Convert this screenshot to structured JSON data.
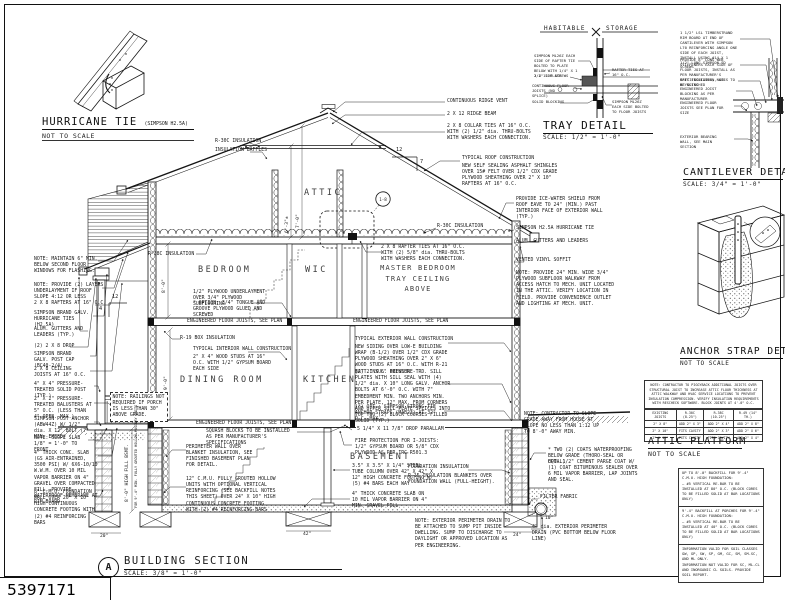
{
  "sheet": {
    "number": "5397171",
    "ink": "#1a1a1a",
    "paper": "#ffffff"
  },
  "hurricane_tie_detail": {
    "title": "HURRICANE TIE",
    "subtitle": "(SIMPSON H2.5A)",
    "scale": "NOT TO SCALE"
  },
  "tray_detail": {
    "title": "TRAY DETAIL",
    "scale": "SCALE: 1/2\" = 1'-0\"",
    "zone_left": "HABITABLE",
    "zone_right": "STORAGE",
    "labels": {
      "simpson_top": "SIMPSON ML26Z EACH SIDE OF RAFTER TIE BOLTED TO PLATE BELOW WITH 1/4\" X 1 1/2\" SDS SCREWS",
      "plate": "2 X 12 PLATE",
      "rafter_ties": "RAFTER TIES AT 16\" O.C.",
      "floor_joists": "CONTINUOUS FLOOR JOISTS (NO SPLICE)",
      "blocking": "SOLID BLOCKING",
      "simpson_bottom": "SIMPSON ML26Z EACH SIDE BOLTED TO FLOOR JOISTS"
    }
  },
  "cantilever_detail": {
    "title": "CANTILEVER DETAIL",
    "scale": "SCALE: 3/4\" = 1'-0\"",
    "labels": {
      "rim_board": "1 1/2\" LSL TIMBERSTRAND RIM BOARD AT END OF CANTILEVER WITH SIMPSON L70 REINFORCING ANGLE ONE SIDE OF EACH JOIST, INSTALL USING #14 X 1 1/2\" LONG SIMPSON SD SCREWS",
      "web_stiffeners": "PROVIDE 8\" LONG WEB STIFFENERS EACH SIDE OF FLOOR JOISTS, INSTALL AS PER MANUFACTURER'S SPECIFICATIONS, NAILS TO BE CLINCHED",
      "batt_insulation": "BATT INSULATION, SEE KEYNOTES",
      "joist_blocking": "ENGINEERED JOIST BLOCKING AS PER MANUFACTURER",
      "floor_joists": "ENGINEERED FLOOR JOISTS SEE PLAN FOR SIZE",
      "bearing_wall": "EXTERIOR BEARING WALL, SEE MAIN SECTION"
    }
  },
  "anchor_strap_detail": {
    "title": "ANCHOR STRAP DETAIL",
    "scale": "NOT TO SCALE"
  },
  "attic_platform": {
    "title": "ATTIC PLATFORM",
    "scale": "NOT TO SCALE",
    "note": "NOTE: CONTRACTOR TO PIGGYBACK ADDITIONAL JOISTS OVER STRUCTURAL JOIST TO INCREASE ATTIC FLOOR THICKNESS AT ATTIC WALKWAY AND HVAC SERVICE LOCATIONS TO PREVENT INSULATION COMPRESSION. VERIFY INSULATION REQUIREMENTS WITH RESCHECK SOFTWARE. BLOCK JOINTS AT 4'-0\" O.C.",
    "table": {
      "headers": [
        "EXISTING JOISTS",
        "R-30C (8.25\")",
        "R-38C (10.25\")",
        "R-49 (14\" TH.)"
      ],
      "rows": [
        [
          "2\" X 8\"",
          "ADD 2\" X 3\"",
          "ADD 2\" X 4\"",
          "ADD 2\" X 8\""
        ],
        [
          "2\" X 10\"",
          "FITS CAVITY",
          "ADD 2\" X 3\"",
          "ADD 2\" X 6\""
        ],
        [
          "2\" X 12\"",
          "FITS CAVITY",
          "FITS CAVITY",
          "ADD 2\" X 4\""
        ]
      ]
    }
  },
  "backfill_notes": {
    "s1_title": "UP TO 8'-0\" BACKFILL FOR 9'-4\" C.M.U. HIGH FOUNDATION:",
    "s1_body": "— #5 VERTICAL RE-BAR TO BE INSTALLED AT 80\" O.C. (BLOCK CORES TO BE FILLED SOLID AT BAR LOCATIONS ONLY)",
    "s2_title": "9'-4\" BACKFILL AT PORCHES FOR 9'-4\" C.M.U. HIGH FOUNDATION:",
    "s2_body": "— #5 VERTICAL RE-BAR TO BE INSTALLED AT 40\" O.C. (BLOCK CORES TO BE FILLED SOLID AT BAR LOCATIONS ONLY)",
    "s3_a": "INFORMATION VALID FOR SOIL CLASSES GW, GP, SW, SP, GM, GC, SM, SM-SC, AND ML ONLY.",
    "s3_b": "INFORMATION NOT VALID FOR SC, ML-CL AND INORGANIC CL SOILS. PROVIDE SOIL REPORT."
  },
  "section": {
    "marker": "A",
    "title": "BUILDING SECTION",
    "scale": "SCALE: 3/8\" = 1'-0\"",
    "rooms": {
      "attic": "ATTIC",
      "bedroom": "BEDROOM",
      "wic": "WIC",
      "master_line1": "MASTER BEDROOM",
      "master_line2": "TRAY CEILING ABOVE",
      "dining": "DINING ROOM",
      "kitchen": "KITCHEN",
      "basement": "BASEMENT"
    },
    "dims": {
      "attic_collar": "6'-3\"±",
      "attic_ridge": "7'-0\"",
      "second_floor": "8'-0\"",
      "first_floor": "9'-0\"",
      "bsmt1": "8'-0\" HIGH FULL BSMT.",
      "bsmt2": "FOR 9'-4\" MIN. FULLY GROUTED HOLLOW MASONRY UNITS",
      "d20": "20\"",
      "d42": "42\"",
      "d24": "24\"",
      "d10": "10\"",
      "pitch_run_main": "12",
      "pitch_rise_main": "7",
      "pitch_run_porch": "12",
      "pitch_rise_porch": "4",
      "bubble_ref": "1-8"
    },
    "labels": {
      "flashing_note": "NOTE: MAINTAIN 6\" MIN. BELOW SECOND FLOOR WINDOWS FOR FLASHING.",
      "underlayment_note": "NOTE: PROVIDE (2) LAYERS UNDERLAYMENT IF ROOF SLOPE 4:12 OR LESS",
      "porch_rafters": "2 X 8 RAFTERS AT 16\" O.C.",
      "porch_hurricane_ties": "SIMPSON BRAND GALV. HURRICANE TIES (H2.5A)",
      "porch_gutters": "ALUM. GUTTERS AND LEADERS (TYP.)",
      "porch_drop": "(2) 2 X 8 DROP",
      "post_cap": "SIMPSON BRAND GALV. POST CAP (BC40-2/4)",
      "porch_ceiling_joists": "2 X 8 CEILING JOISTS AT 16\" O.C.",
      "solid_post": "4\" X 4\" PRESSURE-TREATED SOLID POST (TYP.)",
      "balusters": "2\" X 2\" PRESSURE-TREATED BALUSTERS AT 5\" O.C. (LESS THAN 4\" OPEN. MAX.)",
      "post_anchor": "SIMPSON POST ANCHOR (ABW44Z) W/ 1/2\" dia. X 12\" BOLT (7\" MIN. EMBED)",
      "slope_slab_note": "NOTE: SLOPE SLAB 1/8\" = 1'-0\" TO FRONT",
      "porch_slab": "4\" THICK CONC. SLAB (GS AIR-ENTRAINED, 3500 PSI) W/ 6X6-10/10 W.W.M. OVER 10 MIL VAPOR BARRIER ON 4\" GRAVEL OVER COMPACTED FILL, PROVIDE WATERPROOF MEMBRANE AT RIM BOARD",
      "cmu8_foundation": "8\" C.M.U. FOUNDATION WALL OVER 20\" X 10\" HIGH CONTINUOUS CONCRETE FOOTING WITH (2) #4 REINFORCING BARS",
      "railing_note": "NOTE: RAILINGS NOT REQUIRED IF PORCH IS LESS THAN 30\" ABOVE GRADE.",
      "ridge_vent": "CONTINUOUS RIDGE VENT",
      "ridge_beam": "2 X 12 RIDGE BEAM",
      "collar_ties": "2 X 8 COLLAR TIES AT 16\" O.C. WITH (2) 1/2\" dia. THRU-BOLTS WITH WASHERS EACH CONNECTION.",
      "roof_construction_title": "TYPICAL ROOF CONSTRUCTION",
      "roof_construction_spec": "NEW SELF SEALING ASPHALT SHINGLES OVER 15# FELT OVER 1/2\" CDX GRADE PLYWOOD SHEATHING OVER 2\" X 10\" RAFTERS AT 16\" O.C.",
      "ice_water_shield": "PROVIDE ICE-WATER SHIELD FROM ROOF EAVE TO 24\" (MIN.) PAST INTERIOR FACE OF EXTERIOR WALL (TYP.)",
      "hurricane_tie": "SIMPSON H2.5A HURRICANE TIE",
      "gutters_leaders": "ALUM. GUTTERS AND LEADERS",
      "vinyl_soffit": "VENTED VINYL SOFFIT",
      "attic_walkway_note": "NOTE: PROVIDE 24\" MIN. WIDE 3/4\" PLYWOOD SUBFLOOR WALKWAY FROM ACCESS HATCH TO MECH. UNIT LOCATED IN THE ATTIC. VERIFY LOCATION IN FIELD. PROVIDE CONVENIENCE OUTLET AND LIGHTING AT MECH. UNIT.",
      "rafter_ties": "2 X 8 RAFTER TIES AT 16\" O.C. WITH (2) 5/8\" dia. THRU-BOLTS WITH WASHERS EACH CONNECTION.",
      "r30c_left": "R-30C INSULATION",
      "insulation_baffles": "INSULATION BAFFLES",
      "r30c_right": "R-30C INSULATION",
      "r38c": "R-38C INSULATION",
      "subfloor": "1/2\" PLYWOOD UNDERLAYMENT OVER 3/4\" PLYWOOD SUBFLOORING",
      "subfloor_option": "* OPTION: 3/4\" TONGUE AND GROOVE PLYWOOD GLUED AND SCREWED",
      "efj": "ENGINEERED FLOOR JOISTS, SEE PLAN",
      "r19_box": "R-19 BOX INSULATION",
      "interior_wall_title": "TYPICAL INTERIOR WALL CONSTRUCTION",
      "interior_wall_spec": "2\" X 4\" WOOD STUDS AT 16\" O.C. WITH 1/2\" GYPSUM BOARD EACH SIDE",
      "exterior_wall_title": "TYPICAL EXTERIOR WALL CONSTRUCTION",
      "exterior_wall_spec": "NEW SIDING OVER LOW-E BUILDING WRAP (B-1/2) OVER 1/2\" CDX GRADE PLYWOOD SHEATHING OVER 2\" X 6\" WOOD STUDS AT 16\" O.C. WITH R-21 BATT INSUL. BETWEEN",
      "sill_plates": "(2) 2\" X 6\" PRESSURE-TRD. SILL PLATES WITH SILL SEAL WITH (4) 1/2\" dia. X 10\" LONG GALV. ANCHOR BOLTS AT 6'-0\" O.C. WITH 7\" EMBEDMENT MIN. TWO ANCHORS MIN. PER PLATE, 12\" MAX. FROM CORNERS AND UPPER SILL PLATE SPLICES INTO TOP TWO (2) BLOCK COURSES FILLED SOLID (TYP.)",
      "anchor_strap_option": "(*) OPT.: SIMPSON STRONG-TIE ANCHOR STRAPS (MAB23) AT 32\" O.C. MAX.",
      "grade_slope_note": "NOTE: CONTRACTOR TO SLOPE GRADE AWAY FROM HOUSE AT SLOPE NO LESS THAN 1:12 UP TO 8'-0\" AWAY MIN.",
      "waterproofing": "* TWO (2) COATS WATERPROOFING BELOW GRADE (THORO-SEAL OR EQUAL)",
      "parge_coat": "OPT. 1/2\" CEMENT PARGE COAT W/ (1) COAT BITUMINOUS SEALER OVER 6 MIL VAPOR BARRIER, LAP JOINTS AND SEAL.",
      "filter_fabric": "FILTER FABRIC",
      "perimeter_drain": "4\" dia. EXTERIOR PERIMETER DRAIN (PVC BOTTOM BELOW FLOOR LINE)",
      "foundation_insulation_title": "FOUNDATION INSULATION",
      "foundation_insulation_spec": "R-15 INSULATION BLANKETS OVER FOUNDATION WALL (FULL-HEIGHT).",
      "perimeter_drain_note": "NOTE: EXTERIOR PERIMETER DRAIN TO BE ATTACHED TO SUMP PIT INSIDE DWELLING. SUMP TO DISCHARGE TO DAYLIGHT OR APPROVED LOCATION AS PER ENGINEERING.",
      "squash_blocks": "SQUASH BLOCKS TO BE INSTALLED AS PER MANUFACTURER'S SPECIFICATIONS",
      "perimeter_wall": "PERIMETER WALL OVER BLANKET INSULATION, SEE FINISHED BASEMENT PLAN FOR DETAIL.",
      "cmu12_foundation": "12\" C.M.U. FULLY GROUTED HOLLOW UNITS WITH OPTIONAL VERTICAL REINFORCING (SEE BACKFILL NOTES THIS SHEET) OVER 24\" X 10\" HIGH CONTINUOUS CONCRETE FOOTING WITH (2) #4 REINFORCING BARS",
      "drop_parallam": "5 1/4\" X 11 7/8\" DROP PARALLAM",
      "fire_protection": "FIRE PROTECTION FOR I-JOISTS: 1/2\" GYPSUM BOARD OR 5/8\" CDX PLYWOOD AS PER IRC R501.3",
      "steel_column": "3.5\" X 3.5\" X 1/4\" STEEL TUBE COLUMN OVER 42\" X 42\" X 12\" HIGH CONCRETE FOOTING W/ (5) #4 BARS EACH WAY",
      "basement_slab": "4\" THICK CONCRETE SLAB ON 10 MIL VAPOR BARRIER ON 4\" MIN. GRAVEL FILL"
    }
  }
}
